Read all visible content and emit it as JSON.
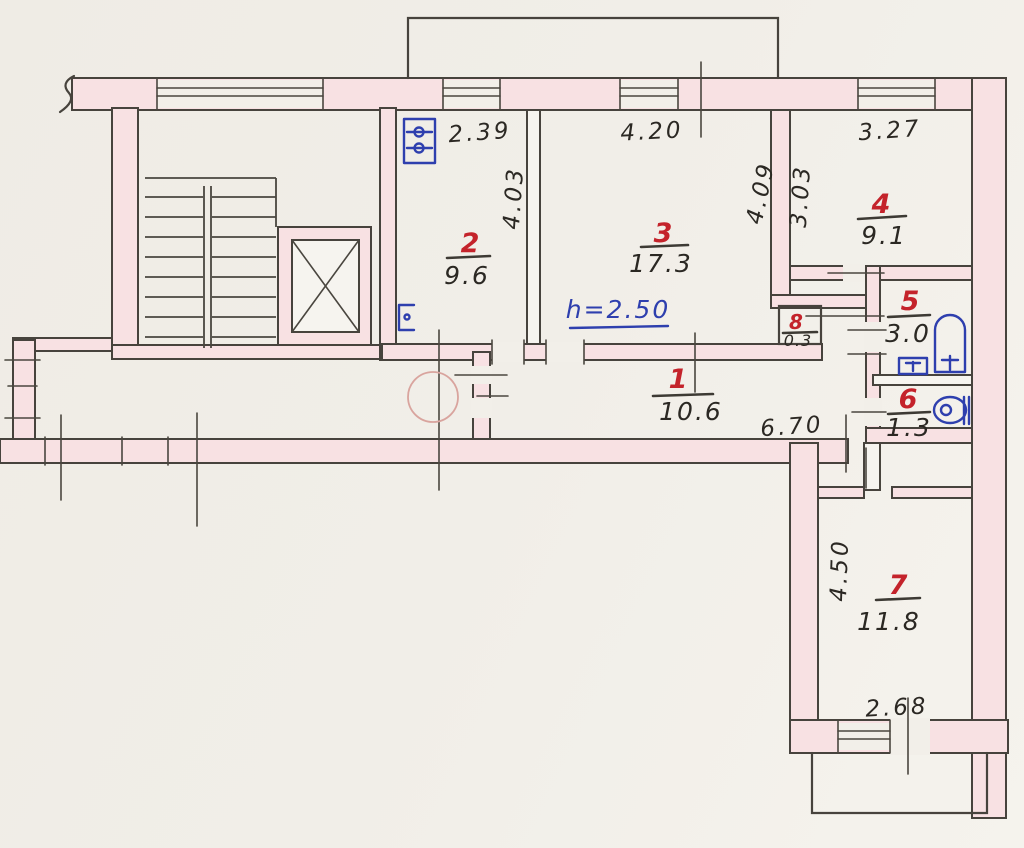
{
  "plan": {
    "kind": "hand-drawn apartment floor plan (scan)",
    "rooms": [
      {
        "number": "1",
        "area": "10.6"
      },
      {
        "number": "2",
        "area": "9.6"
      },
      {
        "number": "3",
        "area": "17.3"
      },
      {
        "number": "4",
        "area": "9.1"
      },
      {
        "number": "5",
        "area": "3.0"
      },
      {
        "number": "6",
        "area": "1.3"
      },
      {
        "number": "7",
        "area": "11.8"
      },
      {
        "number": "8",
        "area": "0.3"
      }
    ],
    "dimensions": {
      "room2_width": "2.39",
      "room2_depth": "4.03",
      "room3_width": "4.20",
      "room3_depth": "4.09",
      "room4_width": "3.27",
      "room4_depth": "3.03",
      "hallway_length": "6.70",
      "room7_depth": "4.50",
      "room7_width": "2.68"
    },
    "notes": {
      "ceiling_height": "h=2.50"
    },
    "fixtures": [
      "staircase",
      "elevator-shaft",
      "electric-panel",
      "socket",
      "bathtub",
      "sink",
      "toilet",
      "balcony-top",
      "balcony-bottom"
    ],
    "palette": {
      "wall_fill": "#f8e1e3",
      "line": "#47433d",
      "room_number": "#c4232b",
      "dimension_text": "#2b2823",
      "height_note": "#2e3fae",
      "fixture_blue": "#2e3fae",
      "faint_circle": "#d9a49e",
      "paper": "#f1eee8"
    }
  }
}
